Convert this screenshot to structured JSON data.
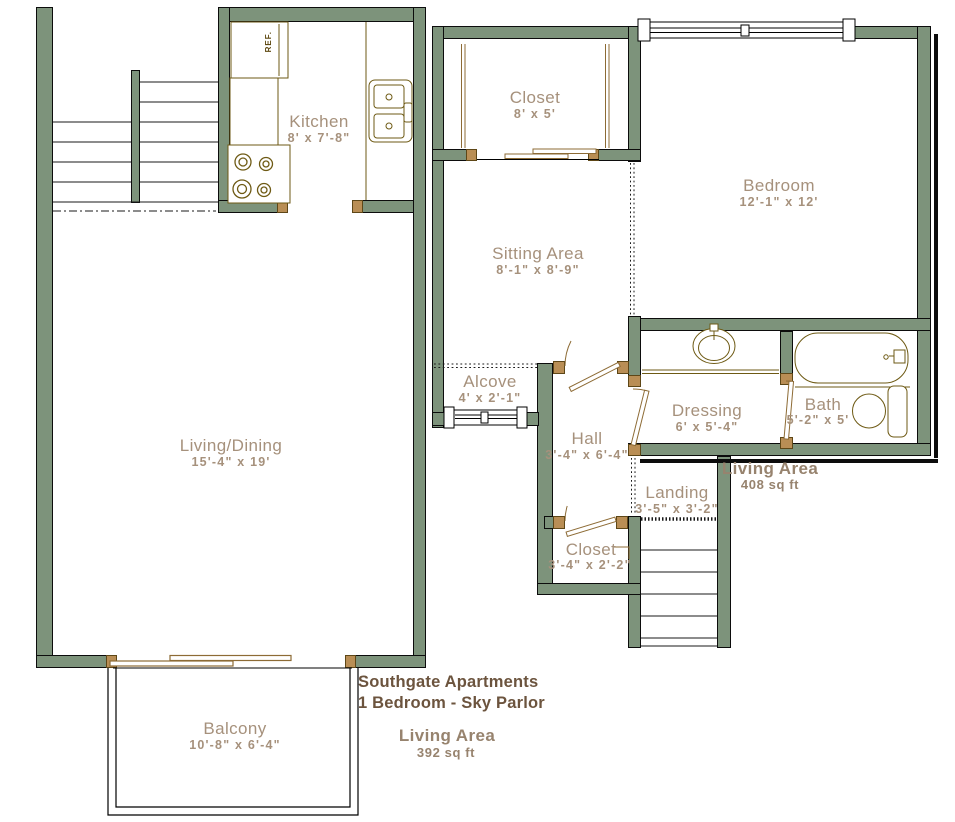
{
  "plan_title": {
    "line1": "Southgate Apartments",
    "line2": "1 Bedroom - Sky Parlor"
  },
  "area_labels": {
    "upper": {
      "label": "Living Area",
      "value": "408 sq ft"
    },
    "lower": {
      "label": "Living Area",
      "value": "392 sq ft"
    }
  },
  "rooms": {
    "kitchen": {
      "name": "Kitchen",
      "dims": "8' x 7'-8\""
    },
    "closet_top": {
      "name": "Closet",
      "dims": "8' x 5'"
    },
    "bedroom": {
      "name": "Bedroom",
      "dims": "12'-1\" x 12'"
    },
    "sitting_area": {
      "name": "Sitting Area",
      "dims": "8'-1\" x 8'-9\""
    },
    "alcove": {
      "name": "Alcove",
      "dims": "4' x 2'-1\""
    },
    "hall": {
      "name": "Hall",
      "dims": "3'-4\" x 6'-4\""
    },
    "dressing": {
      "name": "Dressing",
      "dims": "6' x 5'-4\""
    },
    "bath": {
      "name": "Bath",
      "dims": "5'-2\" x 5'"
    },
    "landing": {
      "name": "Landing",
      "dims": "3'-5\" x 3'-2\""
    },
    "closet_hall": {
      "name": "Closet",
      "dims": "3'-4\" x 2'-2\""
    },
    "living_dining": {
      "name": "Living/Dining",
      "dims": "15'-4\" x 19'"
    },
    "balcony": {
      "name": "Balcony",
      "dims": "10'-8\" x 6'-4\""
    }
  },
  "fixtures": {
    "refrigerator_label": "REF."
  },
  "colors": {
    "wall": "#7d937b",
    "room_label": "#a6917c",
    "area_label": "#97836e",
    "title_text": "#6c543e",
    "fixture_outline": "#6e5a14",
    "door_swing": "#8d6b35"
  }
}
